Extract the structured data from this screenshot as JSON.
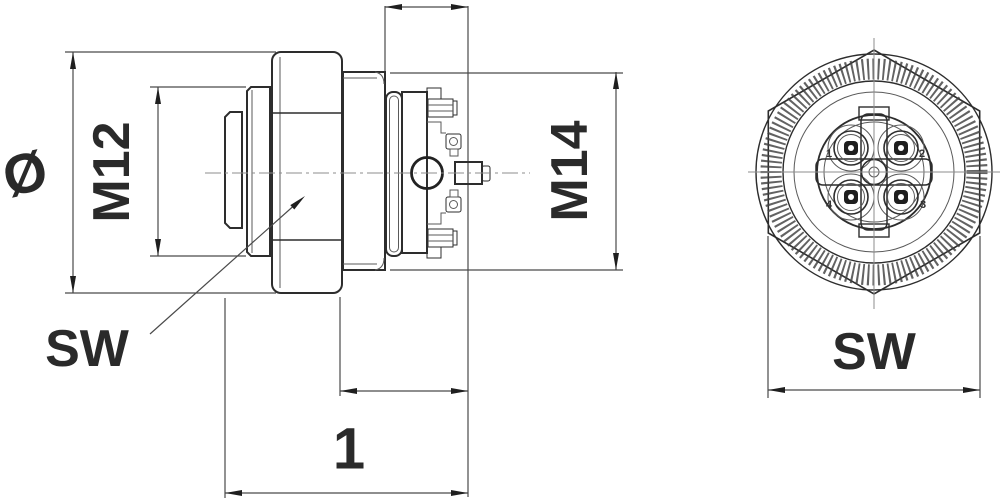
{
  "drawing": {
    "type": "technical-drawing-connector",
    "views": {
      "side_view": {
        "labels": {
          "diameter": "Ø",
          "thread_front": "M12",
          "thread_back": "M14",
          "wrench_size": "SW",
          "dim_one": "1"
        }
      },
      "front_view": {
        "labels": {
          "wrench_size": "SW",
          "pin1": "1",
          "pin2": "2",
          "pin3": "3",
          "pin4": "4"
        },
        "contact_count": 4
      }
    },
    "colors": {
      "background": "#ffffff",
      "outline_ink": "#2d2d2d",
      "dimension_lines": "#4a4a4a",
      "center_lines": "#8c8c8c",
      "contact_fill": "#1e1e1e"
    }
  }
}
